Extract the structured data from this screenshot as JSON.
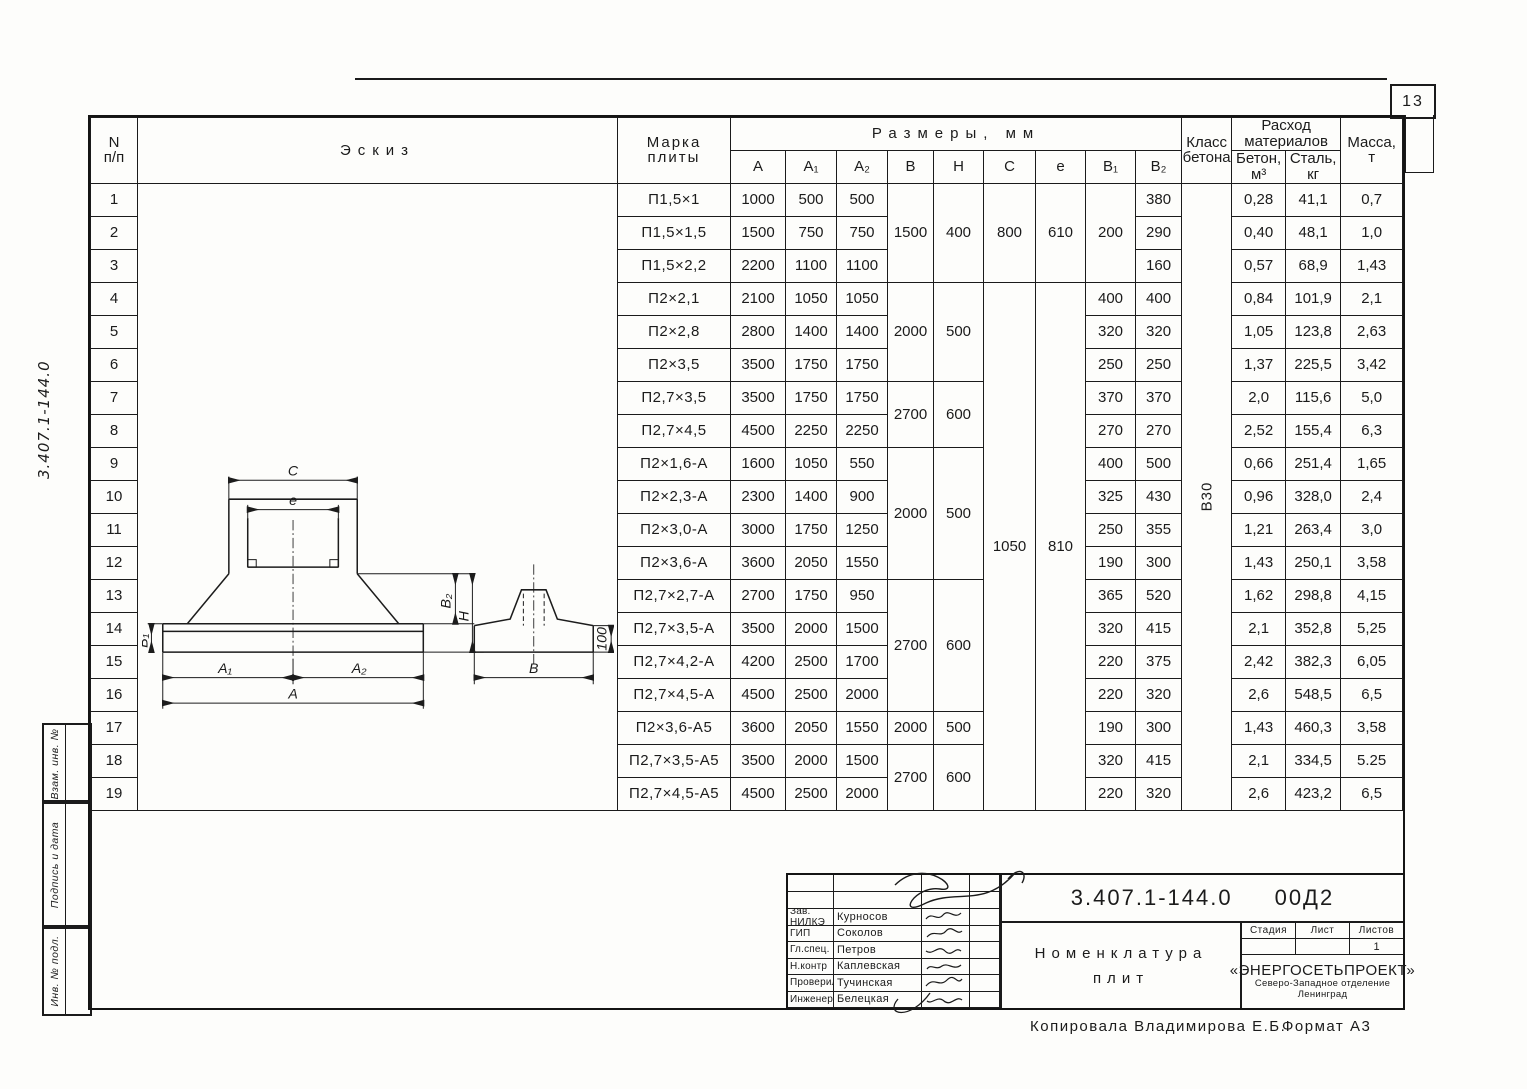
{
  "page": {
    "number": "13"
  },
  "margin": {
    "code": "3.407.1-144.0",
    "stamps": [
      "Взам. инв. №",
      "Подпись и дата",
      "Инв. № подл."
    ]
  },
  "table": {
    "headers": {
      "num_top": "N",
      "num_bottom": "п/п",
      "sketch": "Эскиз",
      "mark1": "Марка",
      "mark2": "плиты",
      "dims": "Размеры, мм",
      "a": "А",
      "a1": "А₁",
      "a2": "А₂",
      "b": "В",
      "h": "Н",
      "c": "С",
      "e": "е",
      "b1": "В₁",
      "b2": "В₂",
      "class1": "Класс",
      "class2": "бетона",
      "consumption1": "Расход",
      "consumption2": "материалов",
      "concrete1": "Бетон,",
      "concrete2": "м³",
      "steel1": "Сталь,",
      "steel2": "кг",
      "mass1": "Масса,",
      "mass2": "т"
    },
    "concrete_class": "В30",
    "rows": [
      {
        "n": "1",
        "mark": "П1,5×1",
        "a": "1000",
        "a1": "500",
        "a2": "500",
        "b": {
          "v": "1500",
          "rs": 3
        },
        "h": {
          "v": "400",
          "rs": 3
        },
        "c": {
          "v": "800",
          "rs": 3
        },
        "e": {
          "v": "610",
          "rs": 3
        },
        "b1": {
          "v": "200",
          "rs": 3
        },
        "b2": "380",
        "concrete": "0,28",
        "steel": "41,1",
        "mass": "0,7"
      },
      {
        "n": "2",
        "mark": "П1,5×1,5",
        "a": "1500",
        "a1": "750",
        "a2": "750",
        "b2": "290",
        "concrete": "0,40",
        "steel": "48,1",
        "mass": "1,0"
      },
      {
        "n": "3",
        "mark": "П1,5×2,2",
        "a": "2200",
        "a1": "1100",
        "a2": "1100",
        "b2": "160",
        "concrete": "0,57",
        "steel": "68,9",
        "mass": "1,43"
      },
      {
        "n": "4",
        "mark": "П2×2,1",
        "a": "2100",
        "a1": "1050",
        "a2": "1050",
        "b": {
          "v": "2000",
          "rs": 3
        },
        "h": {
          "v": "500",
          "rs": 3
        },
        "c": {
          "v": "1050",
          "rs": 16,
          "tall": true
        },
        "e": {
          "v": "810",
          "rs": 16,
          "tall": true
        },
        "b1": {
          "v": "400",
          "rs": 1
        },
        "b2": "400",
        "concrete": "0,84",
        "steel": "101,9",
        "mass": "2,1"
      },
      {
        "n": "5",
        "mark": "П2×2,8",
        "a": "2800",
        "a1": "1400",
        "a2": "1400",
        "b1": {
          "v": "320",
          "rs": 1
        },
        "b2": "320",
        "concrete": "1,05",
        "steel": "123,8",
        "mass": "2,63"
      },
      {
        "n": "6",
        "mark": "П2×3,5",
        "a": "3500",
        "a1": "1750",
        "a2": "1750",
        "b1": {
          "v": "250",
          "rs": 1
        },
        "b2": "250",
        "concrete": "1,37",
        "steel": "225,5",
        "mass": "3,42"
      },
      {
        "n": "7",
        "mark": "П2,7×3,5",
        "a": "3500",
        "a1": "1750",
        "a2": "1750",
        "b": {
          "v": "2700",
          "rs": 2
        },
        "h": {
          "v": "600",
          "rs": 2
        },
        "b1": {
          "v": "370",
          "rs": 1
        },
        "b2": "370",
        "concrete": "2,0",
        "steel": "115,6",
        "mass": "5,0"
      },
      {
        "n": "8",
        "mark": "П2,7×4,5",
        "a": "4500",
        "a1": "2250",
        "a2": "2250",
        "b1": {
          "v": "270",
          "rs": 1
        },
        "b2": "270",
        "concrete": "2,52",
        "steel": "155,4",
        "mass": "6,3"
      },
      {
        "n": "9",
        "mark": "П2×1,6-А",
        "a": "1600",
        "a1": "1050",
        "a2": "550",
        "b": {
          "v": "2000",
          "rs": 4
        },
        "h": {
          "v": "500",
          "rs": 4
        },
        "b1": {
          "v": "400",
          "rs": 1
        },
        "b2": "500",
        "concrete": "0,66",
        "steel": "251,4",
        "mass": "1,65"
      },
      {
        "n": "10",
        "mark": "П2×2,3-А",
        "a": "2300",
        "a1": "1400",
        "a2": "900",
        "b1": {
          "v": "325",
          "rs": 1
        },
        "b2": "430",
        "concrete": "0,96",
        "steel": "328,0",
        "mass": "2,4"
      },
      {
        "n": "11",
        "mark": "П2×3,0-А",
        "a": "3000",
        "a1": "1750",
        "a2": "1250",
        "b1": {
          "v": "250",
          "rs": 1
        },
        "b2": "355",
        "concrete": "1,21",
        "steel": "263,4",
        "mass": "3,0"
      },
      {
        "n": "12",
        "mark": "П2×3,6-А",
        "a": "3600",
        "a1": "2050",
        "a2": "1550",
        "b1": {
          "v": "190",
          "rs": 1
        },
        "b2": "300",
        "concrete": "1,43",
        "steel": "250,1",
        "mass": "3,58"
      },
      {
        "n": "13",
        "mark": "П2,7×2,7-А",
        "a": "2700",
        "a1": "1750",
        "a2": "950",
        "b": {
          "v": "2700",
          "rs": 4
        },
        "h": {
          "v": "600",
          "rs": 4
        },
        "b1": {
          "v": "365",
          "rs": 1
        },
        "b2": "520",
        "concrete": "1,62",
        "steel": "298,8",
        "mass": "4,15"
      },
      {
        "n": "14",
        "mark": "П2,7×3,5-А",
        "a": "3500",
        "a1": "2000",
        "a2": "1500",
        "b1": {
          "v": "320",
          "rs": 1
        },
        "b2": "415",
        "concrete": "2,1",
        "steel": "352,8",
        "mass": "5,25"
      },
      {
        "n": "15",
        "mark": "П2,7×4,2-А",
        "a": "4200",
        "a1": "2500",
        "a2": "1700",
        "b1": {
          "v": "220",
          "rs": 1
        },
        "b2": "375",
        "concrete": "2,42",
        "steel": "382,3",
        "mass": "6,05"
      },
      {
        "n": "16",
        "mark": "П2,7×4,5-А",
        "a": "4500",
        "a1": "2500",
        "a2": "2000",
        "b1": {
          "v": "220",
          "rs": 1
        },
        "b2": "320",
        "concrete": "2,6",
        "steel": "548,5",
        "mass": "6,5"
      },
      {
        "n": "17",
        "mark": "П2×3,6-А5",
        "a": "3600",
        "a1": "2050",
        "a2": "1550",
        "b": {
          "v": "2000",
          "rs": 1
        },
        "h": {
          "v": "500",
          "rs": 1
        },
        "b1": {
          "v": "190",
          "rs": 1
        },
        "b2": "300",
        "concrete": "1,43",
        "steel": "460,3",
        "mass": "3,58"
      },
      {
        "n": "18",
        "mark": "П2,7×3,5-А5",
        "a": "3500",
        "a1": "2000",
        "a2": "1500",
        "b": {
          "v": "2700",
          "rs": 2
        },
        "h": {
          "v": "600",
          "rs": 2
        },
        "b1": {
          "v": "320",
          "rs": 1
        },
        "b2": "415",
        "concrete": "2,1",
        "steel": "334,5",
        "mass": "5.25"
      },
      {
        "n": "19",
        "mark": "П2,7×4,5-А5",
        "a": "4500",
        "a1": "2500",
        "a2": "2000",
        "b1": {
          "v": "220",
          "rs": 1
        },
        "b2": "320",
        "concrete": "2,6",
        "steel": "423,2",
        "mass": "6,5"
      }
    ]
  },
  "sketch": {
    "labels": {
      "c": "С",
      "e": "е",
      "b1": "В₁",
      "b2": "В₂",
      "h": "Н",
      "a1": "А₁",
      "a2": "А₂",
      "a": "А",
      "b": "В",
      "edge": "100"
    }
  },
  "title_block": {
    "doc_number": "3.407.1-144.0",
    "doc_code": "00Д2",
    "title_line1": "Номенклатура",
    "title_line2": "плит",
    "stage_label": "Стадия",
    "sheet_label": "Лист",
    "sheets_label": "Листов",
    "stage_value": "",
    "sheet_value": "",
    "sheets_value": "1",
    "org_name": "«ЭНЕРГОСЕТЬПРОЕКТ»",
    "org_branch": "Северо-Западное отделение",
    "org_city": "Ленинград",
    "people": [
      {
        "role": "Зав. НИЛКЭ",
        "name": "Курносов"
      },
      {
        "role": "ГИП",
        "name": "Соколов"
      },
      {
        "role": "Гл.спец.",
        "name": "Петров"
      },
      {
        "role": "Н.контр",
        "name": "Каплевская"
      },
      {
        "role": "Проверил",
        "name": "Тучинская"
      },
      {
        "role": "Инженер",
        "name": "Белецкая"
      }
    ]
  },
  "footer": {
    "copied": "Копировала Владимирова Е.Б.",
    "format": "Формат А3"
  }
}
